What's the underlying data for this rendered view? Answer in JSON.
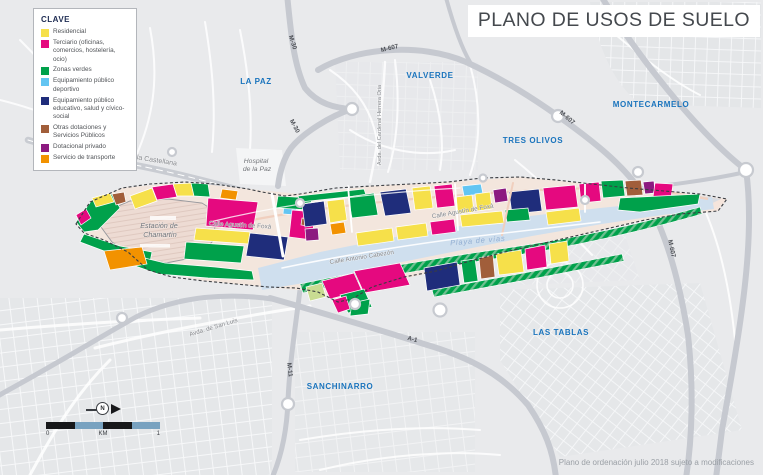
{
  "title": "PLANO DE USOS DE SUELO",
  "legend": {
    "header": "CLAVE",
    "items": [
      {
        "id": "residencial",
        "label": "Residencial",
        "color": "#f6e04a"
      },
      {
        "id": "terciario",
        "label": "Terciario (oficinas, comercios, hostelería, ocio)",
        "color": "#e5097f"
      },
      {
        "id": "zonas-verdes",
        "label": "Zonas verdes",
        "color": "#00a14b"
      },
      {
        "id": "deportivo",
        "label": "Equipamiento público deportivo",
        "color": "#63c5f2"
      },
      {
        "id": "educativo",
        "label": "Equipamiento público educativo, salud y cívico-social",
        "color": "#1f2d7b"
      },
      {
        "id": "otras-dotaciones",
        "label": "Otras dotaciones y Servicios Públicos",
        "color": "#a15e3a"
      },
      {
        "id": "dotacional-privado",
        "label": "Dotacional privado",
        "color": "#8c1a80"
      },
      {
        "id": "transporte",
        "label": "Servicio de transporte",
        "color": "#f29200"
      }
    ]
  },
  "districts": [
    "LA PAZ",
    "VALVERDE",
    "TRES OLIVOS",
    "MONTECARMELO",
    "LAS TABLAS",
    "SANCHINARRO"
  ],
  "road_labels": [
    "M-30",
    "M-30",
    "M-607",
    "M-607",
    "M-607",
    "M-11",
    "A-1"
  ],
  "street_labels": [
    "Paseo de la Castellana",
    "Avda. del Cardenal Herrera Oria",
    "Avda. de San Luis",
    "Calle Agustín de Foxá",
    "Calle Agustín de Foxá",
    "Calle Antonio Cabezón"
  ],
  "places": [
    {
      "line1": "Plaza de",
      "line2": "Castilla"
    },
    {
      "line1": "Hospital",
      "line2": "de la Paz"
    },
    {
      "line1": "Estación de",
      "line2": "Chamartín"
    }
  ],
  "yard_label": "Playa de vías",
  "scalebar": {
    "zero": "0",
    "unit": "KM",
    "one": "1",
    "north_label": "N",
    "north_icon": "north-arrow"
  },
  "footer_note": "Plano de ordenación julio 2018 sujeto a modificaciones",
  "colors": {
    "map_base": "#e9eaec",
    "highway": "#c6c9d0",
    "district_label": "#1a74bd",
    "road_label": "#4b4e54",
    "street_label": "#7f8287",
    "rail_yard": "#cfdfee",
    "station_fill": "#eddbd3",
    "title_text": "#45494e",
    "scalebar_blue": "#78a2c0"
  }
}
